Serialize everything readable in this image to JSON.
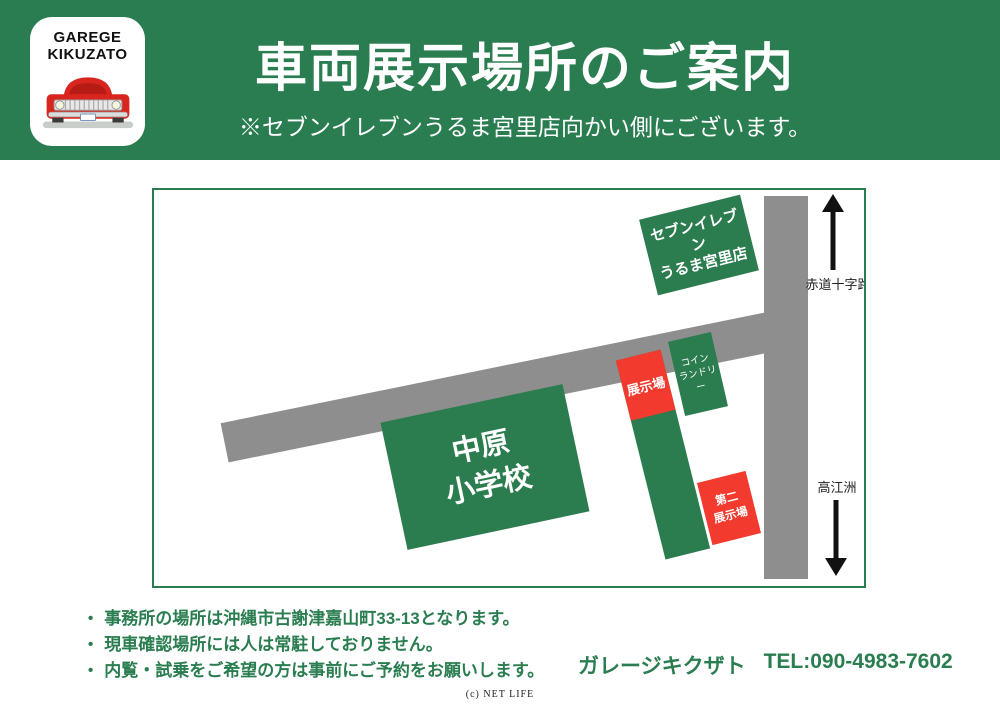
{
  "palette": {
    "brand_green": "#2a7d50",
    "box_green": "#2b7c4e",
    "lot_red": "#f23b2e",
    "road_gray": "#8e8e8e",
    "car_red": "#d8251d",
    "text_white": "#ffffff",
    "label_black": "#222222"
  },
  "header": {
    "logo": {
      "line1": "GAREGE",
      "line2": "KIKUZATO"
    },
    "title": "車両展示場所のご案内",
    "subtitle": "※セブンイレブンうるま宮里店向かい側にございます。"
  },
  "map": {
    "labels": {
      "seven_eleven": {
        "line1": "セブンイレブン",
        "line2": "うるま宮里店"
      },
      "coin_laundry": {
        "line1": "コイン",
        "line2": "ランドリー"
      },
      "school": {
        "line1": "中原",
        "line2": "小学校"
      },
      "display_lot": "展示場",
      "second_lot": {
        "line1": "第二",
        "line2": "展示場"
      },
      "north_road": "赤道十字路",
      "south_road": "高江洲"
    }
  },
  "notes": {
    "bullet": "•",
    "items": [
      "事務所の場所は沖縄市古謝津嘉山町33-13となります。",
      "現車確認場所には人は常駐しておりません。",
      "内覧・試乗をご希望の方は事前にご予約をお願いします。"
    ]
  },
  "contact": {
    "name": "ガレージキクザト",
    "tel": "TEL:090-4983-7602"
  },
  "footer": {
    "credit": "(c) NET LIFE"
  }
}
